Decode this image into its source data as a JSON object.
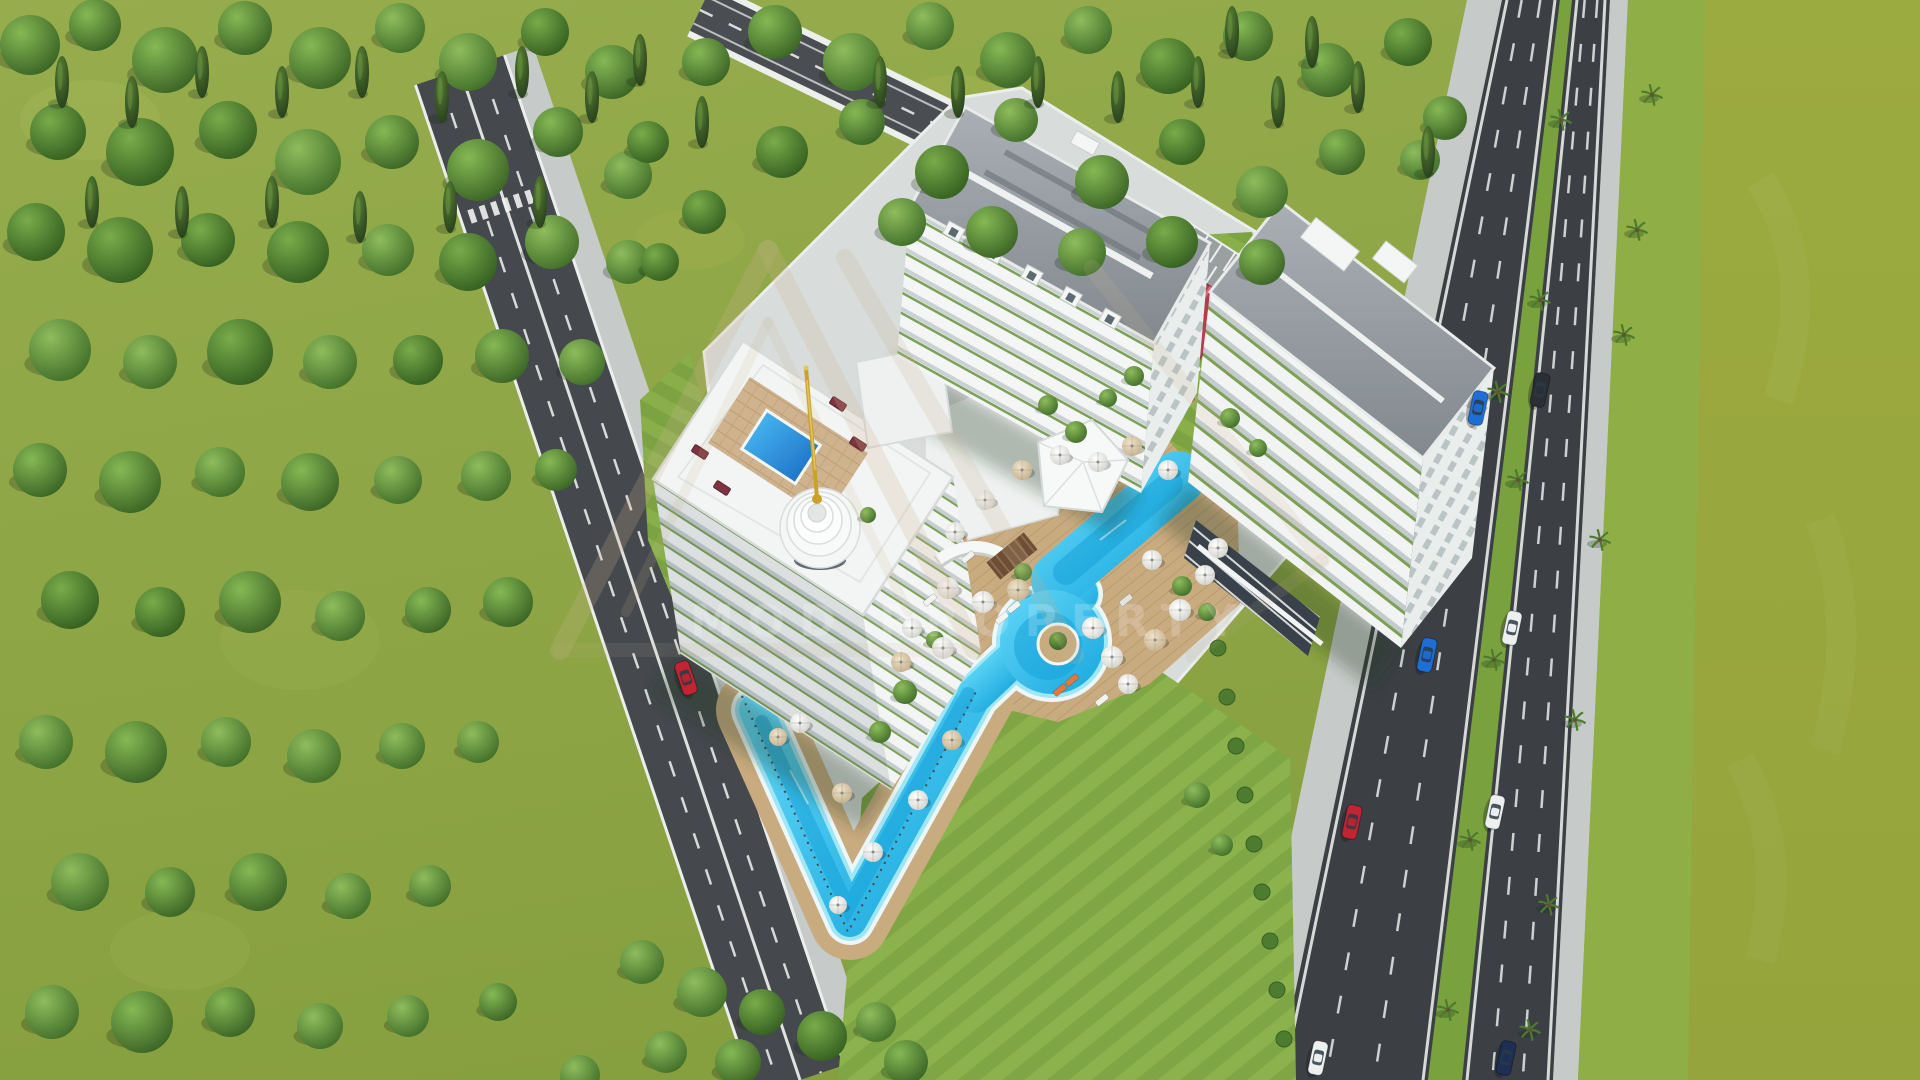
{
  "meta": {
    "title": "Aerial 3D architectural rendering of a seaside residential complex",
    "render_type": "architectural-visualization",
    "visible_text_count": 1
  },
  "watermark": {
    "text": "MOD PROPERTY",
    "logo": "triangle-monogram-outline",
    "logo_color": "#cbb390",
    "text_color": "rgba(255,255,255,0.16)"
  },
  "palette": {
    "grass": "#93a94a",
    "grass_dark": "#89a140",
    "field_olive": "#9cab3f",
    "verge_green": "#8fae46",
    "forest_dark": "#3b6526",
    "asphalt_highway": "#3c4045",
    "asphalt_road": "#45494e",
    "sidewalk": "#c6cac8",
    "platform": "#d8dcdb",
    "building_white": "#f3f5f4",
    "roof_gray": "#99a0a5",
    "pool_cyan": "#2ec3ef",
    "pool_deep": "#149fd8",
    "deck_tan": "#c9ab80",
    "pavilion_red": "#b43c4c",
    "spire_gold": "#c9a227",
    "lounger_maroon": "#7c3440"
  },
  "scene": {
    "buildings": [
      {
        "name": "left-tower-with-rooftop-pool-and-spire",
        "floors": "12+",
        "features": [
          "rooftop pool",
          "gold spire",
          "tiered dome",
          "wrap-around lap pool"
        ]
      },
      {
        "name": "center-tower",
        "floors": "13",
        "features": [
          "gray hipped roof",
          "dormers",
          "green balcony planters"
        ]
      },
      {
        "name": "right-tower",
        "floors": "12",
        "features": [
          "gray roof",
          "penthouse boxes",
          "ground-floor storefront glass"
        ]
      }
    ],
    "trees": [
      [
        30,
        45,
        30
      ],
      [
        95,
        25,
        26
      ],
      [
        165,
        60,
        33
      ],
      [
        245,
        28,
        27
      ],
      [
        320,
        58,
        31
      ],
      [
        400,
        28,
        25
      ],
      [
        468,
        62,
        29
      ],
      [
        545,
        32,
        24
      ],
      [
        612,
        72,
        27
      ],
      [
        58,
        132,
        28
      ],
      [
        140,
        152,
        34
      ],
      [
        228,
        130,
        29
      ],
      [
        308,
        162,
        33
      ],
      [
        392,
        142,
        27
      ],
      [
        478,
        170,
        31
      ],
      [
        558,
        132,
        25
      ],
      [
        628,
        175,
        24
      ],
      [
        36,
        232,
        29
      ],
      [
        120,
        250,
        33
      ],
      [
        208,
        240,
        27
      ],
      [
        298,
        252,
        31
      ],
      [
        388,
        250,
        26
      ],
      [
        468,
        262,
        29
      ],
      [
        552,
        242,
        27
      ],
      [
        628,
        262,
        22
      ],
      [
        60,
        350,
        31
      ],
      [
        150,
        362,
        27
      ],
      [
        240,
        352,
        33
      ],
      [
        330,
        362,
        27
      ],
      [
        418,
        360,
        25
      ],
      [
        502,
        356,
        27
      ],
      [
        582,
        362,
        23
      ],
      [
        40,
        470,
        27
      ],
      [
        130,
        482,
        31
      ],
      [
        220,
        472,
        25
      ],
      [
        310,
        482,
        29
      ],
      [
        398,
        480,
        24
      ],
      [
        486,
        476,
        25
      ],
      [
        556,
        470,
        21
      ],
      [
        70,
        600,
        29
      ],
      [
        160,
        612,
        25
      ],
      [
        250,
        602,
        31
      ],
      [
        340,
        616,
        25
      ],
      [
        428,
        610,
        23
      ],
      [
        508,
        602,
        25
      ],
      [
        46,
        742,
        27
      ],
      [
        136,
        752,
        31
      ],
      [
        226,
        742,
        25
      ],
      [
        314,
        756,
        27
      ],
      [
        402,
        746,
        23
      ],
      [
        478,
        742,
        21
      ],
      [
        80,
        882,
        29
      ],
      [
        170,
        892,
        25
      ],
      [
        258,
        882,
        29
      ],
      [
        348,
        896,
        23
      ],
      [
        430,
        886,
        21
      ],
      [
        52,
        1012,
        27
      ],
      [
        142,
        1022,
        31
      ],
      [
        230,
        1012,
        25
      ],
      [
        320,
        1026,
        23
      ],
      [
        408,
        1016,
        21
      ],
      [
        498,
        1002,
        19
      ],
      [
        706,
        62,
        24
      ],
      [
        775,
        32,
        27
      ],
      [
        852,
        62,
        29
      ],
      [
        930,
        26,
        24
      ],
      [
        1008,
        60,
        28
      ],
      [
        1088,
        30,
        24
      ],
      [
        1168,
        66,
        28
      ],
      [
        1248,
        36,
        25
      ],
      [
        1328,
        70,
        27
      ],
      [
        1408,
        42,
        24
      ],
      [
        1445,
        118,
        22
      ],
      [
        782,
        152,
        26
      ],
      [
        862,
        122,
        23
      ],
      [
        942,
        172,
        27
      ],
      [
        1016,
        120,
        22
      ],
      [
        1102,
        182,
        27
      ],
      [
        1182,
        142,
        23
      ],
      [
        1262,
        192,
        26
      ],
      [
        1342,
        152,
        23
      ],
      [
        1420,
        160,
        20
      ],
      [
        902,
        222,
        24
      ],
      [
        992,
        232,
        26
      ],
      [
        1082,
        252,
        24
      ],
      [
        1172,
        242,
        26
      ],
      [
        1262,
        262,
        23
      ],
      [
        704,
        212,
        22
      ],
      [
        648,
        142,
        21
      ],
      [
        660,
        262,
        19
      ],
      [
        642,
        962,
        22
      ],
      [
        702,
        992,
        25
      ],
      [
        762,
        1012,
        23
      ],
      [
        822,
        1036,
        25
      ],
      [
        876,
        1022,
        20
      ],
      [
        906,
        1062,
        22
      ],
      [
        666,
        1052,
        21
      ],
      [
        738,
        1062,
        23
      ],
      [
        580,
        1075,
        20
      ]
    ],
    "pines": [
      [
        62,
        82
      ],
      [
        132,
        102
      ],
      [
        202,
        72
      ],
      [
        282,
        92
      ],
      [
        362,
        72
      ],
      [
        442,
        97
      ],
      [
        522,
        72
      ],
      [
        592,
        97
      ],
      [
        92,
        202
      ],
      [
        182,
        212
      ],
      [
        272,
        202
      ],
      [
        360,
        217
      ],
      [
        450,
        207
      ],
      [
        540,
        202
      ],
      [
        880,
        82
      ],
      [
        958,
        92
      ],
      [
        1038,
        82
      ],
      [
        1118,
        97
      ],
      [
        1198,
        82
      ],
      [
        1278,
        102
      ],
      [
        1358,
        87
      ],
      [
        1428,
        152
      ],
      [
        1312,
        42
      ],
      [
        1232,
        32
      ],
      [
        702,
        122
      ],
      [
        640,
        60
      ]
    ],
    "ornamental_trees": [
      [
        1048,
        405,
        10
      ],
      [
        1076,
        432,
        11
      ],
      [
        1108,
        398,
        9
      ],
      [
        1134,
        376,
        10
      ],
      [
        1023,
        572,
        9
      ],
      [
        1182,
        586,
        10
      ],
      [
        1207,
        612,
        9
      ],
      [
        935,
        640,
        9
      ],
      [
        868,
        515,
        8
      ],
      [
        1230,
        418,
        10
      ],
      [
        1258,
        448,
        9
      ],
      [
        905,
        692,
        12
      ],
      [
        880,
        732,
        11
      ],
      [
        1197,
        795,
        13
      ],
      [
        1222,
        845,
        11
      ]
    ],
    "hedges": [
      [
        1218,
        648
      ],
      [
        1227,
        697
      ],
      [
        1236,
        746
      ],
      [
        1245,
        795
      ],
      [
        1254,
        844
      ],
      [
        1262,
        892
      ],
      [
        1270,
        941
      ],
      [
        1277,
        990
      ],
      [
        1284,
        1039
      ]
    ],
    "palms": [
      [
        1561,
        120
      ],
      [
        1540,
        300
      ],
      [
        1518,
        480
      ],
      [
        1494,
        660
      ],
      [
        1470,
        840
      ],
      [
        1448,
        1010
      ],
      [
        1652,
        95
      ],
      [
        1637,
        230
      ],
      [
        1624,
        335
      ],
      [
        1600,
        540
      ],
      [
        1575,
        720
      ],
      [
        1549,
        905
      ],
      [
        1530,
        1030
      ],
      [
        1498,
        392
      ]
    ],
    "umbrellas": [
      [
        948,
        588,
        11,
        0
      ],
      [
        983,
        602,
        11,
        0
      ],
      [
        1018,
        590,
        11,
        1
      ],
      [
        912,
        628,
        10,
        0
      ],
      [
        943,
        648,
        11,
        0
      ],
      [
        901,
        662,
        10,
        1
      ],
      [
        1093,
        628,
        11,
        0
      ],
      [
        1112,
        657,
        11,
        0
      ],
      [
        1128,
        684,
        10,
        0
      ],
      [
        1155,
        640,
        11,
        1
      ],
      [
        1180,
        610,
        11,
        0
      ],
      [
        1205,
        575,
        10,
        0
      ],
      [
        1152,
        560,
        10,
        0
      ],
      [
        1098,
        462,
        10,
        0
      ],
      [
        1132,
        446,
        10,
        1
      ],
      [
        1168,
        470,
        10,
        0
      ],
      [
        1060,
        455,
        10,
        0
      ],
      [
        1022,
        470,
        10,
        1
      ],
      [
        985,
        500,
        10,
        0
      ],
      [
        955,
        532,
        10,
        0
      ],
      [
        873,
        852,
        10,
        0
      ],
      [
        842,
        793,
        10,
        1
      ],
      [
        800,
        723,
        10,
        0
      ],
      [
        918,
        800,
        10,
        0
      ],
      [
        952,
        740,
        10,
        1
      ],
      [
        1218,
        548,
        10,
        0
      ],
      [
        838,
        905,
        9,
        0
      ],
      [
        778,
        737,
        9,
        1
      ]
    ],
    "loungers": [
      [
        1002,
        618,
        -39,
        "#f2f2ef"
      ],
      [
        1014,
        607,
        -39,
        "#f2f2ef"
      ],
      [
        968,
        557,
        -39,
        "#f2f2ef"
      ],
      [
        1102,
        700,
        -39,
        "#f2f2ef"
      ],
      [
        1126,
        600,
        -39,
        "#e2e4e2"
      ],
      [
        1060,
        690,
        -39,
        "#e07840"
      ],
      [
        1072,
        680,
        -39,
        "#e07840"
      ],
      [
        930,
        600,
        -39,
        "#f2f2ef"
      ]
    ],
    "cars": [
      {
        "x": 686,
        "y": 678,
        "rot": 71.5,
        "color": "#c02534"
      },
      {
        "x": 1478,
        "y": 408,
        "rot": 102,
        "color": "#1d6fd6"
      },
      {
        "x": 1427,
        "y": 655,
        "rot": 102,
        "color": "#1d6fd6"
      },
      {
        "x": 1352,
        "y": 822,
        "rot": 102,
        "color": "#c02534"
      },
      {
        "x": 1318,
        "y": 1058,
        "rot": 102,
        "color": "#eef0f0"
      },
      {
        "x": 1540,
        "y": 390,
        "rot": 102,
        "color": "#2a2f36"
      },
      {
        "x": 1512,
        "y": 628,
        "rot": 102,
        "color": "#eef0f0"
      },
      {
        "x": 1495,
        "y": 812,
        "rot": 102,
        "color": "#eef0f0"
      },
      {
        "x": 1506,
        "y": 1058,
        "rot": 102,
        "color": "#1d2f55"
      }
    ],
    "rooftop_sofas": [
      [
        700,
        452
      ],
      [
        722,
        488
      ],
      [
        838,
        404
      ],
      [
        858,
        444
      ]
    ],
    "playground_items": [
      [
        1162,
        402,
        "#d34040"
      ],
      [
        1176,
        410,
        "#e08030"
      ],
      [
        1190,
        400,
        "#d34040"
      ],
      [
        1152,
        413,
        "#c03838"
      ]
    ],
    "dormer_positions": [
      0.18,
      0.34,
      0.5,
      0.66,
      0.82
    ]
  }
}
